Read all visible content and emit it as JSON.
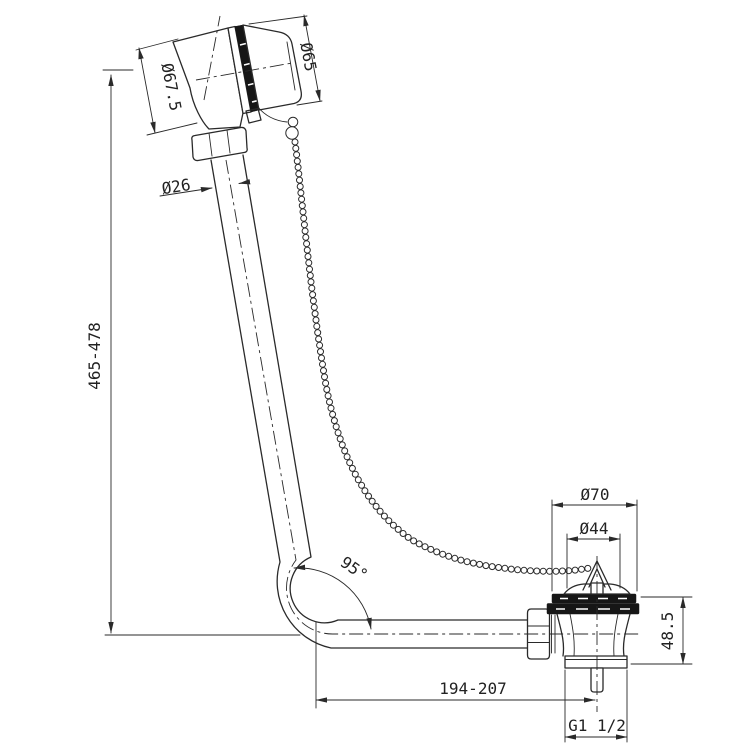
{
  "drawing": {
    "background": "#ffffff",
    "line_color": "#2a2a2a",
    "labels": {
      "overall_height": "465-478",
      "overflow_body_diameter": "Ø67.5",
      "overflow_cap_diameter": "Ø65",
      "pipe_diameter": "Ø26",
      "bend_angle": "95°",
      "waste_flange_diameter": "Ø70",
      "plug_diameter": "Ø44",
      "waste_height": "48.5",
      "pipe_length_range": "194-207",
      "thread_size": "G1 1/2"
    }
  }
}
